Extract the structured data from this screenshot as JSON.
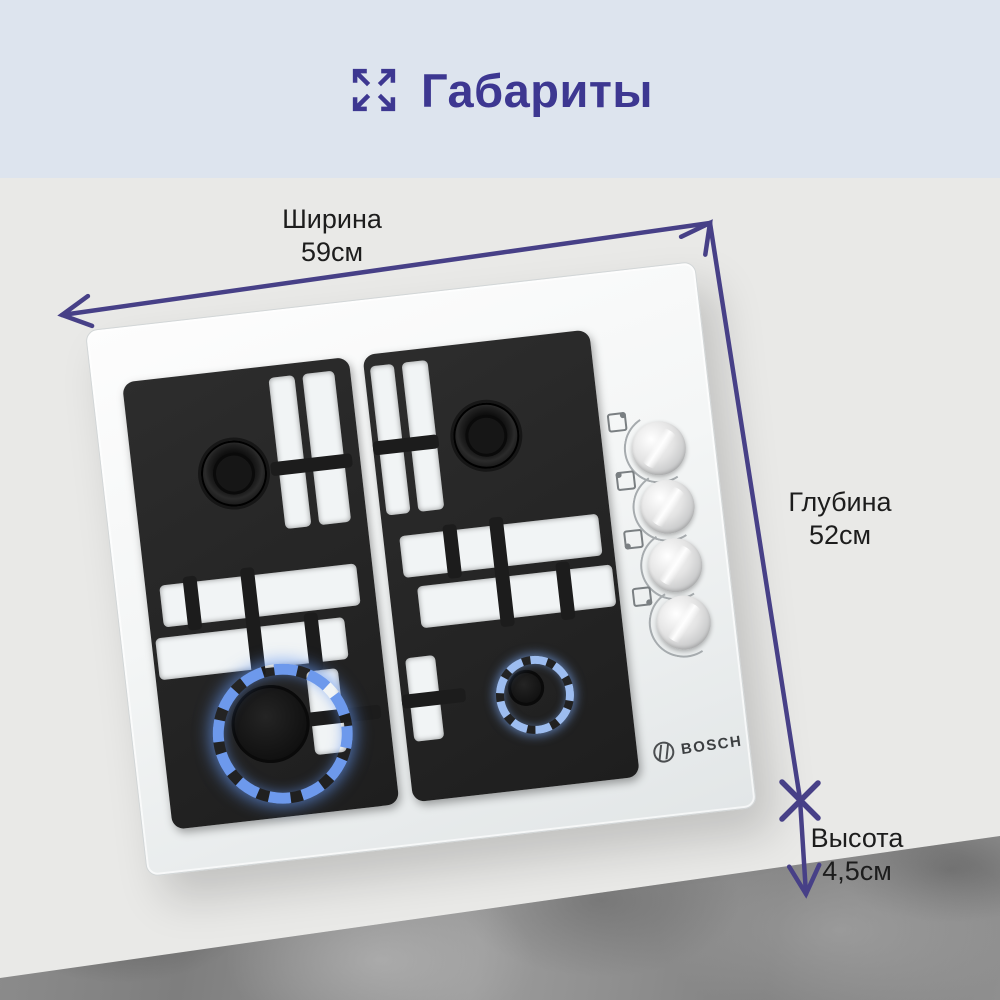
{
  "banner": {
    "title": "Габариты",
    "icon": "expand-arrows-icon",
    "background": "#dde4ee",
    "title_color": "#3d3791"
  },
  "dimensions": {
    "width": {
      "label": "Ширина",
      "value": "59см"
    },
    "depth": {
      "label": "Глубина",
      "value": "52см"
    },
    "height": {
      "label": "Высота",
      "value": "4,5см"
    }
  },
  "product": {
    "brand": "BOSCH",
    "type": "4-burner gas hob, white glass, black cast-iron grates",
    "lit_burners": [
      "front-left large blue flame ring",
      "front-right small blue flame ring"
    ],
    "knob_count": 4,
    "knob_dot_positions": [
      "top-right",
      "top-left",
      "bottom-left",
      "bottom-right"
    ]
  },
  "colors": {
    "accent_purple": "#474087",
    "scene_background": "#e9e9e7",
    "flame_blue": "#6d99ec",
    "label_text": "#1d1d1d",
    "marble_gray": "#8e8e8e"
  }
}
